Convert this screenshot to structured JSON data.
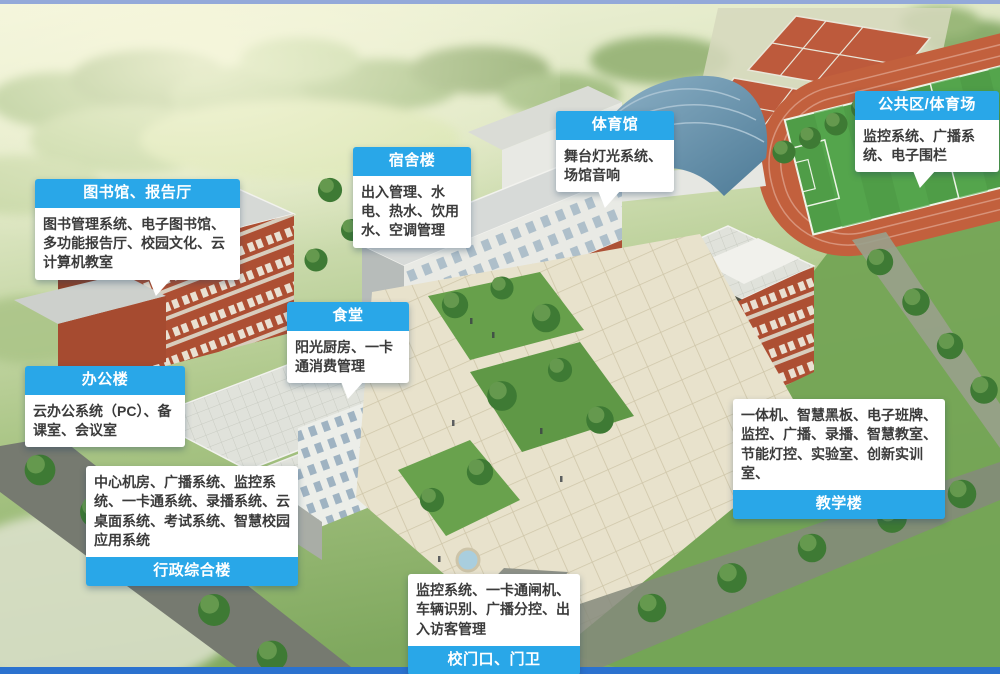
{
  "accent_color": "#29a7e8",
  "labels": [
    {
      "id": "library",
      "title": "图书馆、报告厅",
      "body": "图书管理系统、电子图书馆、多功能报告厅、校园文化、云计算机教室"
    },
    {
      "id": "office",
      "title": "办公楼",
      "body": "云办公系统（PC）、备课室、会议室"
    },
    {
      "id": "admin",
      "title": "行政综合楼",
      "body": "中心机房、广播系统、监控系统、一卡通系统、录播系统、云桌面系统、考试系统、智慧校园应用系统"
    },
    {
      "id": "dorm",
      "title": "宿舍楼",
      "body": "出入管理、水电、热水、饮用水、空调管理"
    },
    {
      "id": "canteen",
      "title": "食堂",
      "body": "阳光厨房、一卡通消费管理"
    },
    {
      "id": "gym",
      "title": "体育馆",
      "body": "舞台灯光系统、场馆音响"
    },
    {
      "id": "public",
      "title": "公共区/体育场",
      "body": "监控系统、广播系统、电子围栏"
    },
    {
      "id": "teaching",
      "title": "教学楼",
      "body": "一体机、智慧黑板、电子班牌、监控、广播、录播、智慧教室、节能灯控、实验室、创新实训室、"
    },
    {
      "id": "gate",
      "title": "校门口、门卫",
      "body": "监控系统、一卡通闸机、车辆识别、广播分控、出入访客管理"
    }
  ]
}
